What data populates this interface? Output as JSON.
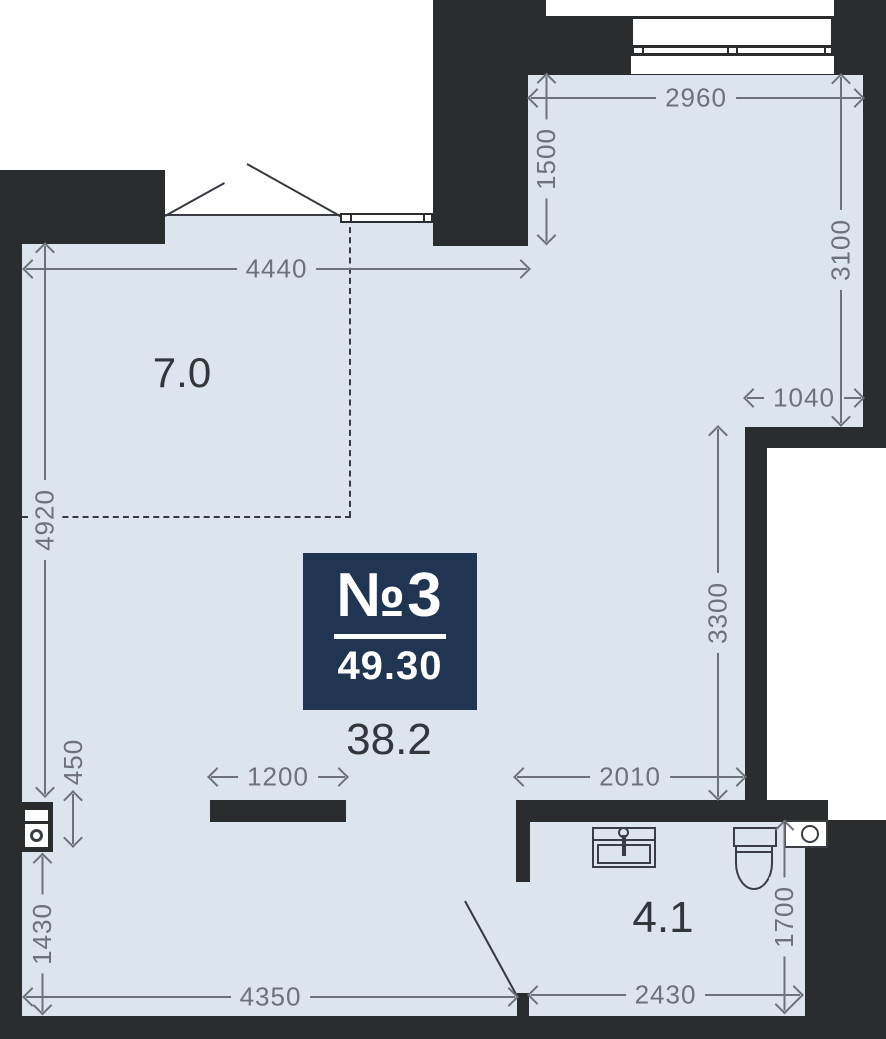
{
  "plan": {
    "badge": {
      "number": "№3",
      "area": "49.30"
    },
    "rooms": {
      "hallway": {
        "area": "7.0"
      },
      "main": {
        "area": "38.2"
      },
      "bathroom": {
        "area": "4.1"
      }
    },
    "dimensions_mm": {
      "top_width": "2960",
      "balcony_depth": "1500",
      "right_upper": "3100",
      "hall_width": "4440",
      "niche_width": "1040",
      "left_height": "4920",
      "right_mid": "3300",
      "island_width": "1200",
      "opening_width": "2010",
      "washer_niche": "450",
      "left_lower": "1430",
      "bottom_width": "4350",
      "bathroom_width": "2430",
      "bathroom_depth": "1700"
    },
    "fixtures": [
      "entry-double-door",
      "balcony-window",
      "entry-window",
      "kitchen-partition",
      "washing-machine",
      "sink",
      "toilet",
      "ventilation-shaft",
      "bathroom-door"
    ],
    "colors": {
      "wall": "#2b2c2e",
      "floor": "#dce4ee",
      "dimension": "#6e7278",
      "ink": "#33363b",
      "badge_bg": "#1f3551",
      "badge_text": "#ffffff",
      "line": "#36393f"
    }
  }
}
